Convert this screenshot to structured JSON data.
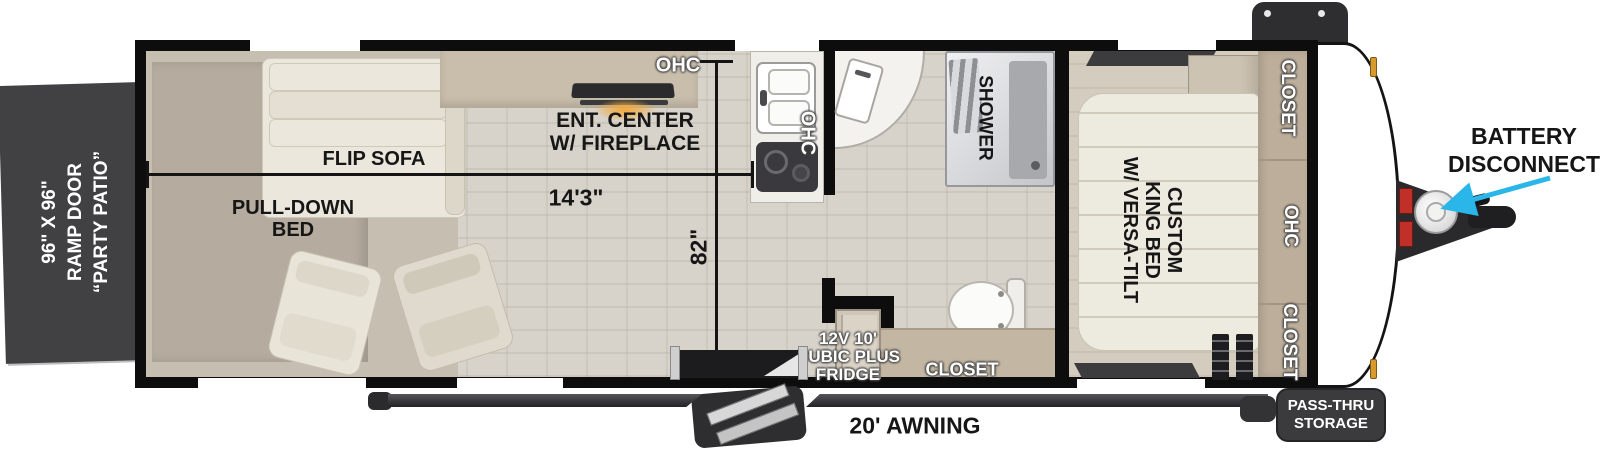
{
  "floorplan": {
    "rear_door": {
      "lines": [
        "96\" X 96\"",
        "RAMP DOOR",
        "“PARTY PATIO”"
      ]
    },
    "living": {
      "flip_sofa": "FLIP SOFA",
      "pull_down_bed_lines": [
        "PULL-DOWN",
        "BED"
      ],
      "ent_center_lines": [
        "ENT. CENTER",
        "W/ FIREPLACE"
      ],
      "ohc_top": "OHC",
      "ohc_kitchen": "OHC"
    },
    "dimensions": {
      "width_label": "14'3\"",
      "height_label": "82\""
    },
    "bath": {
      "shower": "SHOWER",
      "closet": "CLOSET",
      "fridge_lines": [
        "12V 10'",
        "CUBIC PLUS",
        "FRIDGE"
      ]
    },
    "bedroom": {
      "bed_lines": [
        "CUSTOM",
        "KING BED",
        "W/ VERSA-TILT"
      ],
      "closet_top": "CLOSET",
      "ohc": "OHC",
      "closet_bottom": "CLOSET"
    },
    "exterior": {
      "battery_lines": [
        "BATTERY",
        "DISCONNECT"
      ],
      "awning": "20' AWNING",
      "pass_thru_lines": [
        "PASS-THRU",
        "STORAGE"
      ]
    }
  },
  "colors": {
    "wall": "#0d0d0d",
    "floor": "#d8d3ca",
    "ramp_door": "#414144",
    "arrow_accent": "#2ab6e9",
    "cabinet_tan": "#bcae9a",
    "furniture_cream": "#ebe7dc",
    "label_dark": "#161616",
    "label_light": "#ffffff"
  }
}
